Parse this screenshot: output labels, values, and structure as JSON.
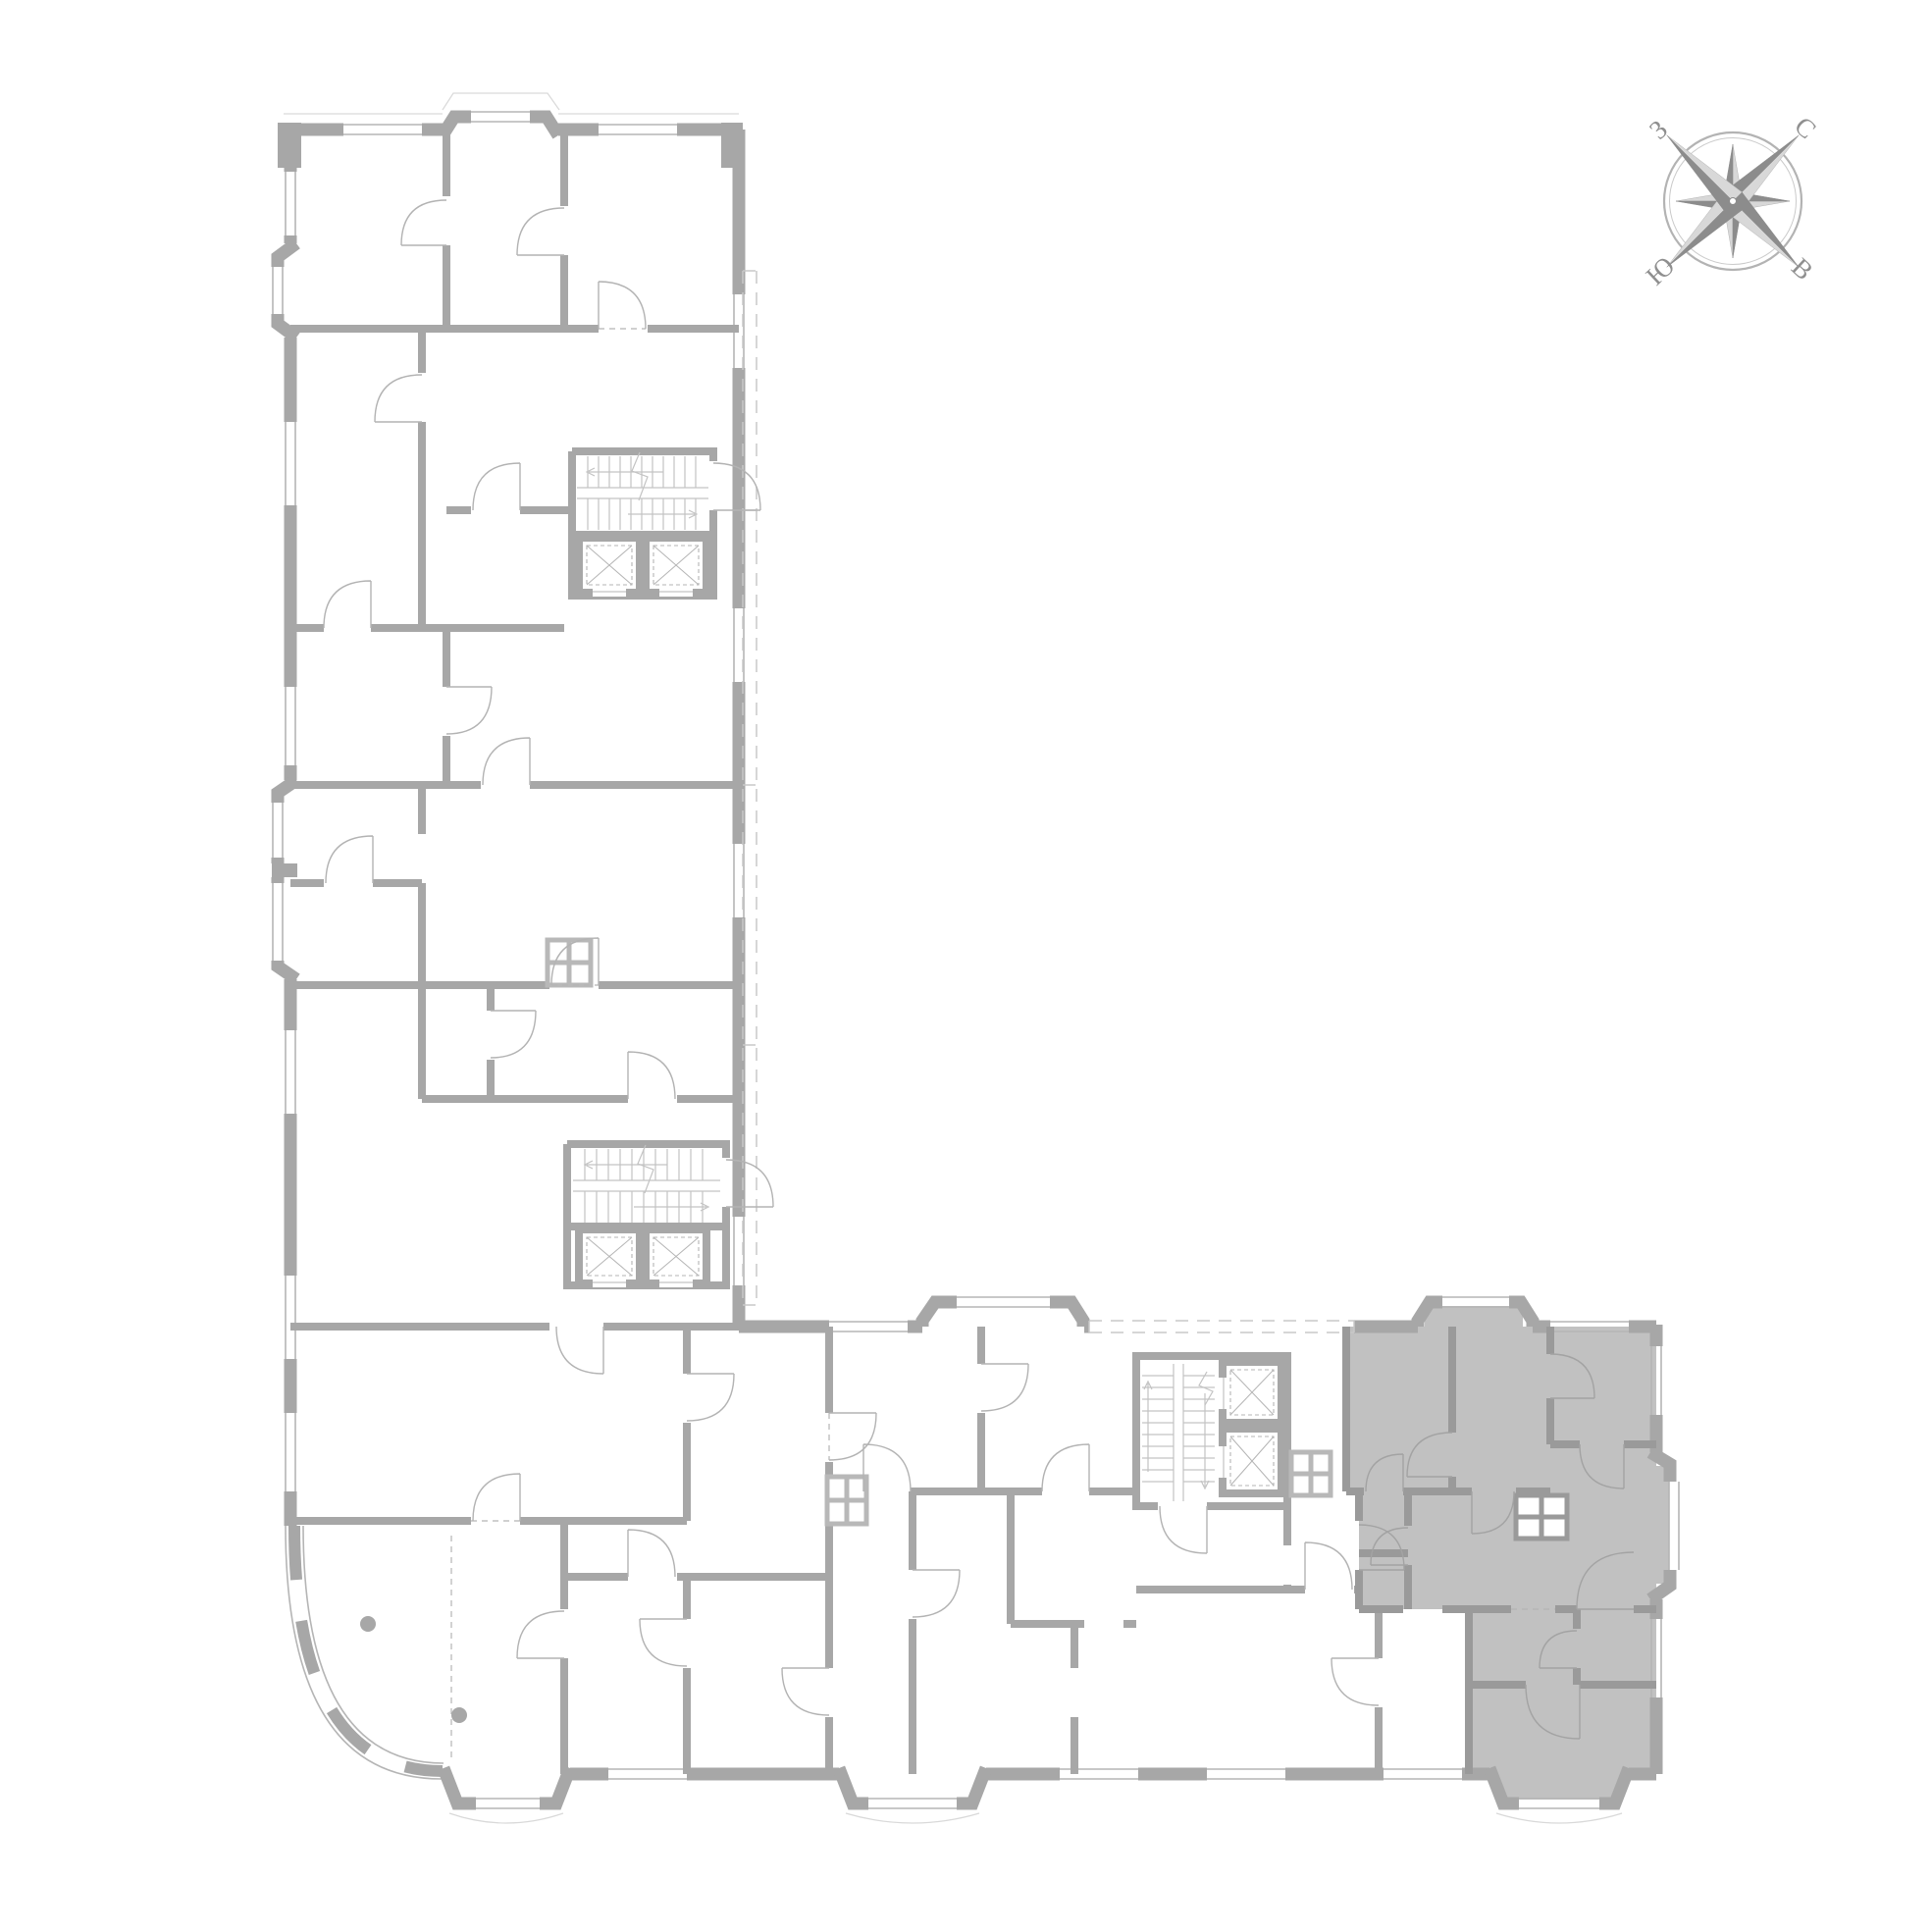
{
  "compass": {
    "labels": {
      "north": "С",
      "east": "В",
      "south": "Ю",
      "west": "З"
    }
  },
  "colors": {
    "background": "#ffffff",
    "wall": "#a7a7a7",
    "wall_light": "#b8b8b8",
    "thin": "#b5b5b5",
    "facade": "#d9d9d9",
    "dashed": "#c8c8c8",
    "door": "#b3b3b3",
    "tread": "#c3c3c3",
    "highlight_fill": "#c1c1c1",
    "highlight_wall": "#9a9a9a",
    "highlight_door": "#a3a3a3",
    "compass_dark": "#8c8c8c",
    "compass_light": "#d8d8d8",
    "compass_ring": "#b3b3b3",
    "compass_text": "#8f8f8f"
  },
  "icons": {
    "compass": "compass-rose-icon",
    "stairs": "stairs-icon",
    "elevator": "elevator-icon"
  }
}
